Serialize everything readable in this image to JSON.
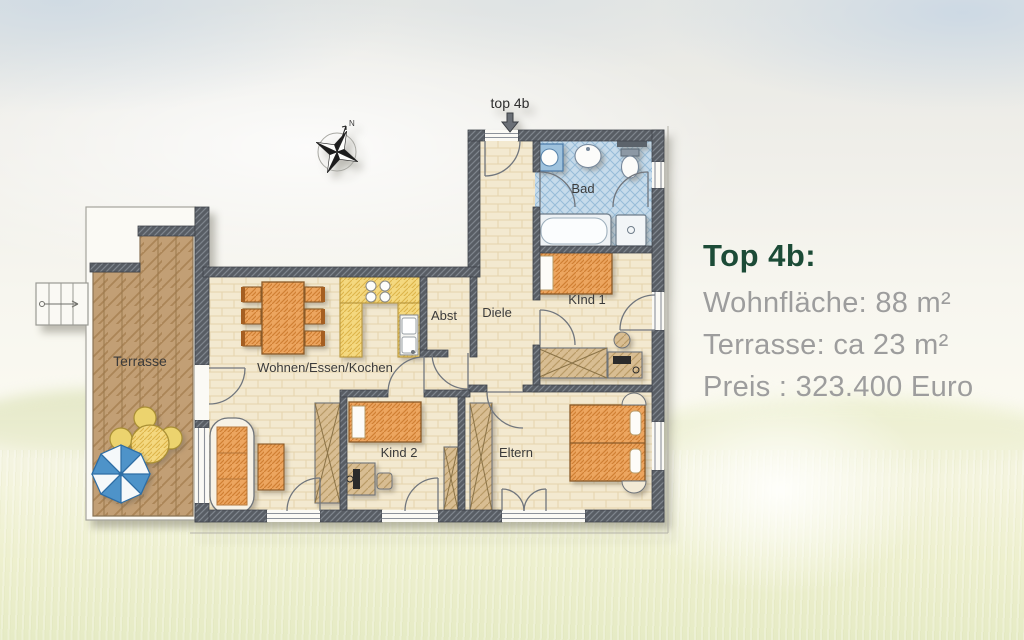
{
  "info_panel": {
    "title": "Top 4b:",
    "title_color": "#1c4b37",
    "text_color": "#9d9d9d",
    "area_line": "Wohnfläche: 88 m²",
    "terrace_line": "Terrasse: ca 23 m²",
    "price_line": "Preis : 323.400 Euro"
  },
  "plan": {
    "entrance_label": "top 4b",
    "compass_north": "N",
    "rooms": {
      "terrasse": "Terrasse",
      "wohnen": "Wohnen/Essen/Kochen",
      "abst": "Abst",
      "diele": "Diele",
      "bad": "Bad",
      "kind1": "KInd 1",
      "kind2": "Kind 2",
      "eltern": "Eltern"
    },
    "colors": {
      "wall": "#585d64",
      "floor": "#f3e9d0",
      "terrace_wood": "#c29f75",
      "furniture_orange": "#eca55f",
      "kitchen_yellow": "#f4d87f",
      "bath_blue": "#c6dbeb"
    }
  }
}
